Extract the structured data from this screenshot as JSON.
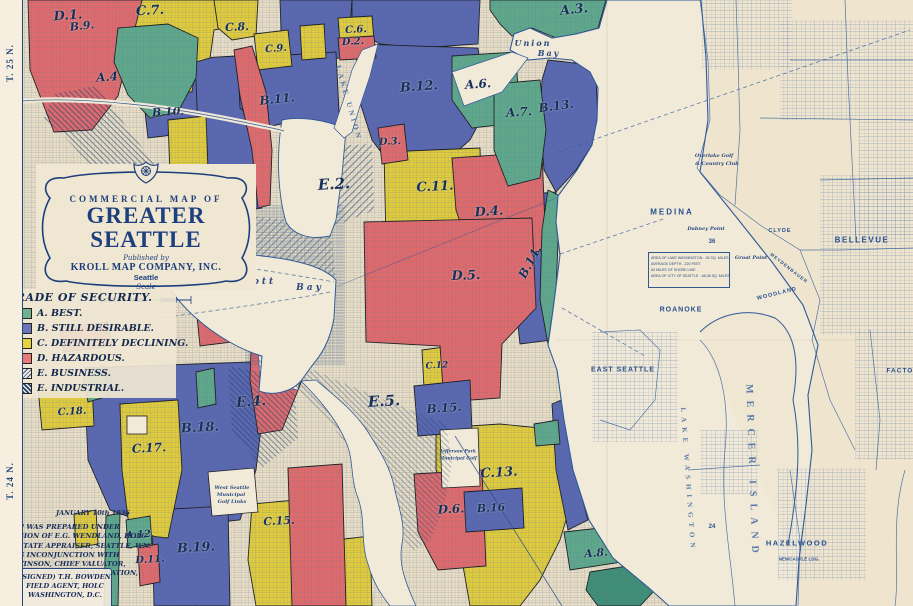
{
  "title_block": {
    "line1": "COMMERCIAL MAP OF",
    "line2": "GREATER SEATTLE",
    "published_by": "Published by",
    "publisher": "KROLL MAP COMPANY, INC.",
    "city": "Seattle",
    "scale_label": "Scale"
  },
  "legend": {
    "title": "GRADE OF SECURITY.",
    "items": [
      {
        "grade": "A.",
        "label": "BEST.",
        "color": "#6fb08d",
        "pattern": "solid"
      },
      {
        "grade": "B.",
        "label": "STILL DESIRABLE.",
        "color": "#6a74b8",
        "pattern": "solid"
      },
      {
        "grade": "C.",
        "label": "DEFINITELY DECLINING.",
        "color": "#e7d23c",
        "pattern": "solid"
      },
      {
        "grade": "D.",
        "label": "HAZARDOUS.",
        "color": "#ea7a78",
        "pattern": "solid"
      },
      {
        "grade": "E.",
        "label": "BUSINESS.",
        "color": "",
        "pattern": "hatch-business"
      },
      {
        "grade": "E.",
        "label": "INDUSTRIAL.",
        "color": "",
        "pattern": "hatch-industrial"
      }
    ]
  },
  "margin": {
    "township_top": "T. 25 N.",
    "township_bottom": "T. 24 N."
  },
  "notes": {
    "date": "JANUARY 10th 1936",
    "lines": [
      "THIS MAP WAS PREPARED UNDER",
      "SUPERVISION OF E.G. WENDLAND, HOLC",
      "DEPUTY STATE APPRAISER, SEATTLE, WN.",
      "WORKING INCONJUNCTION WITH",
      "M.R. PATTINSON, CHIEF VALUATOR,",
      "FEDERAL HOUSING ADMINISTRATION,",
      "SEATTLE, WASHINGTON."
    ],
    "signature": [
      "(SIGNED) T.H. BOWDEN",
      "FIELD AGENT, HOLC",
      "WASHINGTON, D.C."
    ]
  },
  "stats_box": {
    "lines": [
      "AREA OF LAKE WASHINGTON - 26 SQ. MILES",
      "AVERAGE DEPTH - 220 FEET",
      "60 MILES OF SHORE LINE",
      "AREA OF CITY OF SEATTLE - 68.38 SQ. MILES"
    ]
  },
  "districts": [
    {
      "label": "D.1.",
      "x": 68,
      "y": 16,
      "size": 13,
      "rot": -4
    },
    {
      "label": "B.9.",
      "x": 82,
      "y": 26,
      "size": 11,
      "rot": -6
    },
    {
      "label": "C.7.",
      "x": 150,
      "y": 11,
      "size": 13,
      "rot": -3
    },
    {
      "label": "C.8.",
      "x": 237,
      "y": 27,
      "size": 11,
      "rot": -3
    },
    {
      "label": "C.9.",
      "x": 276,
      "y": 49,
      "size": 10,
      "rot": -5
    },
    {
      "label": "A.4",
      "x": 107,
      "y": 77,
      "size": 12,
      "rot": -4
    },
    {
      "label": "B.10.",
      "x": 168,
      "y": 112,
      "size": 11,
      "rot": -3
    },
    {
      "label": "B.11.",
      "x": 277,
      "y": 99,
      "size": 12,
      "rot": -6
    },
    {
      "label": "C.6.",
      "x": 356,
      "y": 30,
      "size": 10,
      "rot": -3
    },
    {
      "label": "D.2.",
      "x": 353,
      "y": 42,
      "size": 10,
      "rot": -3
    },
    {
      "label": "B.12.",
      "x": 419,
      "y": 87,
      "size": 13,
      "rot": -4
    },
    {
      "label": "A.6.",
      "x": 478,
      "y": 84,
      "size": 12,
      "rot": -4
    },
    {
      "label": "A.3.",
      "x": 574,
      "y": 10,
      "size": 13,
      "rot": -6
    },
    {
      "label": "A.7.",
      "x": 519,
      "y": 112,
      "size": 12,
      "rot": -4
    },
    {
      "label": "B.13.",
      "x": 556,
      "y": 106,
      "size": 12,
      "rot": -8
    },
    {
      "label": "D.3.",
      "x": 390,
      "y": 142,
      "size": 10,
      "rot": -3
    },
    {
      "label": "E.2.",
      "x": 334,
      "y": 184,
      "size": 15,
      "rot": -3
    },
    {
      "label": "C.11.",
      "x": 435,
      "y": 187,
      "size": 13,
      "rot": -3
    },
    {
      "label": "D.4.",
      "x": 489,
      "y": 212,
      "size": 13,
      "rot": -4
    },
    {
      "label": "D.5.",
      "x": 466,
      "y": 276,
      "size": 13,
      "rot": -2
    },
    {
      "label": "B.14.",
      "x": 530,
      "y": 262,
      "size": 12,
      "rot": -62
    },
    {
      "label": "E.4.",
      "x": 251,
      "y": 402,
      "size": 14,
      "rot": -4
    },
    {
      "label": "E.5.",
      "x": 384,
      "y": 401,
      "size": 15,
      "rot": -3
    },
    {
      "label": "C.12",
      "x": 437,
      "y": 366,
      "size": 9,
      "rot": -3
    },
    {
      "label": "B.15.",
      "x": 444,
      "y": 408,
      "size": 12,
      "rot": -4
    },
    {
      "label": "C.13.",
      "x": 499,
      "y": 473,
      "size": 13,
      "rot": -3
    },
    {
      "label": "B.16",
      "x": 491,
      "y": 508,
      "size": 11,
      "rot": -3
    },
    {
      "label": "D.6.",
      "x": 451,
      "y": 509,
      "size": 12,
      "rot": -3
    },
    {
      "label": "B.18.",
      "x": 200,
      "y": 428,
      "size": 13,
      "rot": -3
    },
    {
      "label": "C.17.",
      "x": 149,
      "y": 448,
      "size": 12,
      "rot": -3
    },
    {
      "label": "C.18.",
      "x": 72,
      "y": 412,
      "size": 10,
      "rot": -3
    },
    {
      "label": "B.19.",
      "x": 196,
      "y": 548,
      "size": 13,
      "rot": -3
    },
    {
      "label": "C.15.",
      "x": 279,
      "y": 521,
      "size": 11,
      "rot": -3
    },
    {
      "label": "A.12.",
      "x": 140,
      "y": 535,
      "size": 10,
      "rot": -3
    },
    {
      "label": "D.11.",
      "x": 150,
      "y": 560,
      "size": 10,
      "rot": -3
    },
    {
      "label": "A.8.",
      "x": 596,
      "y": 553,
      "size": 11,
      "rot": -4
    }
  ],
  "places": [
    {
      "t": "MEDINA",
      "x": 672,
      "y": 212,
      "s": 8,
      "style": "town",
      "ls": 2
    },
    {
      "t": "BELLEVUE",
      "x": 862,
      "y": 240,
      "s": 8,
      "style": "town",
      "ls": 1.5
    },
    {
      "t": "CLYDE",
      "x": 780,
      "y": 231,
      "s": 5.5,
      "style": "town",
      "ls": 1
    },
    {
      "t": "WOODLAND",
      "x": 777,
      "y": 294,
      "s": 5.5,
      "style": "town",
      "ls": 1,
      "rot": -14
    },
    {
      "t": "MEYDENBAUER",
      "x": 789,
      "y": 268,
      "s": 4.5,
      "style": "town",
      "ls": 1,
      "rot": 38
    },
    {
      "t": "Dabney Point",
      "x": 706,
      "y": 229,
      "s": 5,
      "style": "script"
    },
    {
      "t": "Groat Point",
      "x": 751,
      "y": 258,
      "s": 5,
      "style": "script"
    },
    {
      "t": "ROANOKE",
      "x": 681,
      "y": 310,
      "s": 7,
      "style": "town",
      "ls": 1
    },
    {
      "t": "EAST SEATTLE",
      "x": 623,
      "y": 370,
      "s": 7,
      "style": "town",
      "ls": 1
    },
    {
      "t": "HAZELWOOD",
      "x": 797,
      "y": 543,
      "s": 7.5,
      "style": "town",
      "ls": 1.5
    },
    {
      "t": "NEWCASTLE LDG.",
      "x": 799,
      "y": 559,
      "s": 4.5,
      "style": "town"
    },
    {
      "t": "FACTORIA",
      "x": 907,
      "y": 371,
      "s": 6.5,
      "style": "town",
      "ls": 1
    },
    {
      "t": "Union",
      "x": 533,
      "y": 43,
      "s": 8,
      "style": "script",
      "ls": 2
    },
    {
      "t": "Bay",
      "x": 549,
      "y": 53,
      "s": 8,
      "style": "script",
      "ls": 2
    },
    {
      "t": "Elliott",
      "x": 250,
      "y": 282,
      "s": 9,
      "style": "script",
      "ls": 3
    },
    {
      "t": "Bay",
      "x": 310,
      "y": 288,
      "s": 9,
      "style": "script",
      "ls": 3
    },
    {
      "t": "Overlake Golf",
      "x": 714,
      "y": 156,
      "s": 5,
      "style": "script"
    },
    {
      "t": "& Country Club",
      "x": 717,
      "y": 164,
      "s": 5,
      "style": "script"
    },
    {
      "t": "West Seattle",
      "x": 232,
      "y": 488,
      "s": 5,
      "style": "script"
    },
    {
      "t": "Municipal",
      "x": 231,
      "y": 495,
      "s": 5,
      "style": "script"
    },
    {
      "t": "Golf Links",
      "x": 232,
      "y": 502,
      "s": 5,
      "style": "script"
    },
    {
      "t": "Jefferson Park",
      "x": 458,
      "y": 452,
      "s": 4.5,
      "style": "script"
    },
    {
      "t": "Municipal Golf",
      "x": 458,
      "y": 459,
      "s": 4.5,
      "style": "script"
    },
    {
      "t": "LAKE UNION",
      "x": 349,
      "y": 103,
      "s": 7.5,
      "style": "watervert",
      "ls": 3,
      "rot": 74
    },
    {
      "t": "MERCER ISLAND",
      "x": 752,
      "y": 472,
      "s": 10,
      "style": "watervert",
      "ls": 7,
      "rot": 88
    },
    {
      "t": "LAKE WASHINGTON",
      "x": 688,
      "y": 480,
      "s": 7,
      "style": "watervert",
      "ls": 5,
      "rot": 86
    },
    {
      "t": "36",
      "x": 712,
      "y": 242,
      "s": 6,
      "style": "town"
    },
    {
      "t": "24",
      "x": 712,
      "y": 527,
      "s": 6,
      "style": "town"
    }
  ],
  "map_colors": {
    "parchment": "#efe5cf",
    "water": "#f2ead8",
    "ink": "#1d3f7e",
    "grade_a": "#5fa98a",
    "grade_b": "#5a67b0",
    "grade_c": "#e2cc3c",
    "grade_d": "#e26a6a"
  }
}
